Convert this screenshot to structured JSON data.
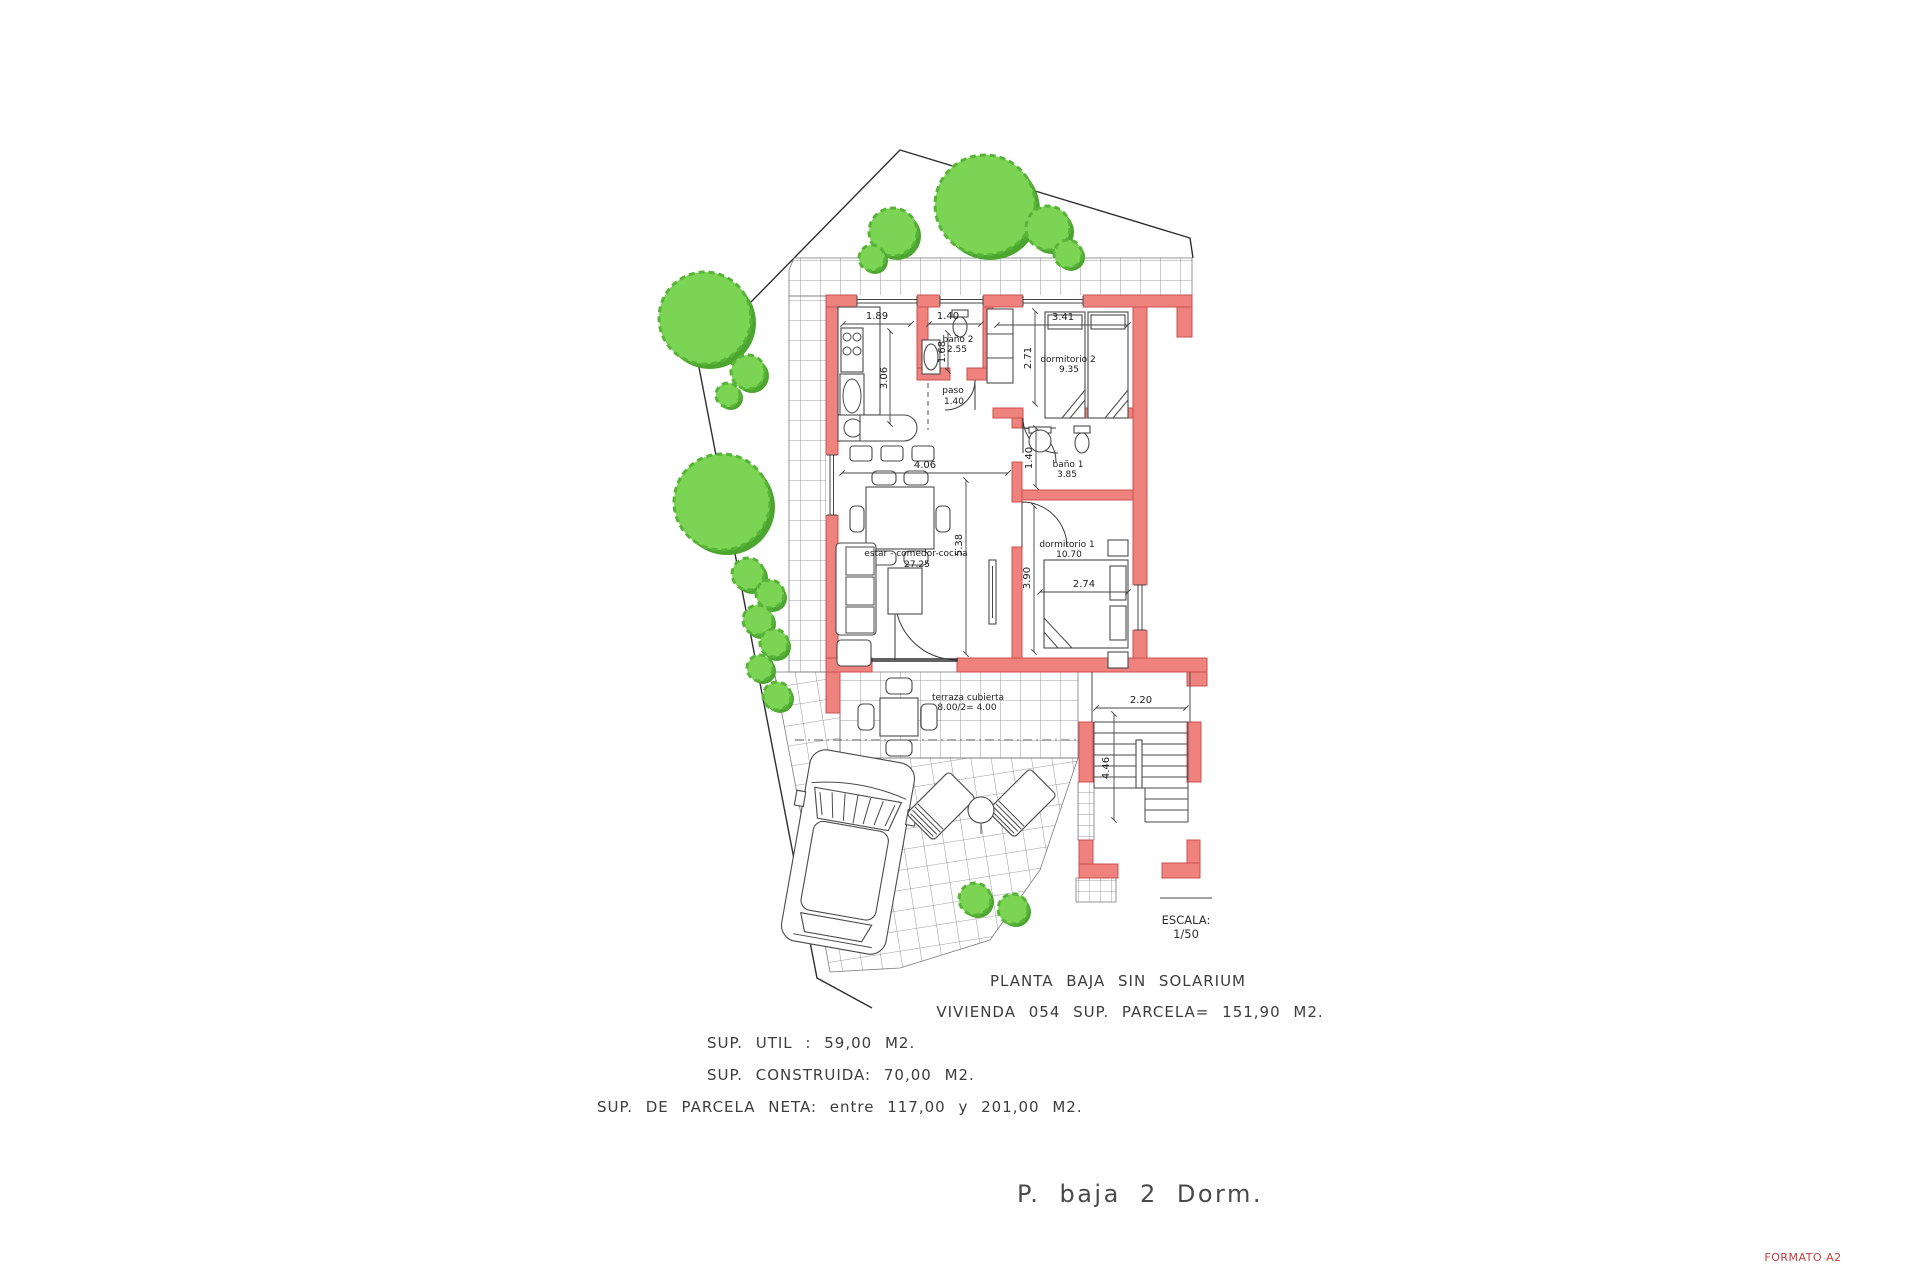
{
  "colors": {
    "wall": "#F0827E",
    "wall_stroke": "#C9504C",
    "tree": "#7CD455",
    "tree_shadow": "#4CA52F",
    "formato": "#C43B3B"
  },
  "plan": {
    "title": "PLANTA BAJA SIN SOLARIUM",
    "subtitle": "VIVIENDA 054 SUP. PARCELA= 151,90 M2.",
    "sup_util": "SUP. UTIL : 59,00 M2.",
    "sup_construida": "SUP. CONSTRUIDA: 70,00 M2.",
    "sup_parcela": "SUP. DE PARCELA NETA: entre 117,00 y 201,00 M2.",
    "plan_name": "P. baja 2 Dorm.",
    "format": "FORMATO A2"
  },
  "scale": {
    "label": "ESCALA:",
    "value": "1/50"
  },
  "rooms": {
    "living": {
      "label": "estar - comedor-cocina",
      "area": "27.25"
    },
    "paso": {
      "label": "paso",
      "area": "1.40"
    },
    "bano2": {
      "label": "baño 2",
      "area": "2.55"
    },
    "dorm2": {
      "label": "dormitorio 2",
      "area": "9.35"
    },
    "bano1": {
      "label": "baño 1",
      "area": "3.85"
    },
    "dorm1": {
      "label": "dormitorio 1",
      "area": "10.70"
    },
    "terraza": {
      "label": "terraza cubierta",
      "area": "8.00/2= 4.00"
    }
  },
  "dims": {
    "d189": "1.89",
    "d140": "1.40",
    "d341": "3.41",
    "d306": "3.06",
    "d168": "1.68",
    "d271": "2.71",
    "d406": "4.06",
    "d538": "5.38",
    "d390": "3.90",
    "d274": "2.74",
    "d220": "2.20",
    "d446": "4.46"
  }
}
